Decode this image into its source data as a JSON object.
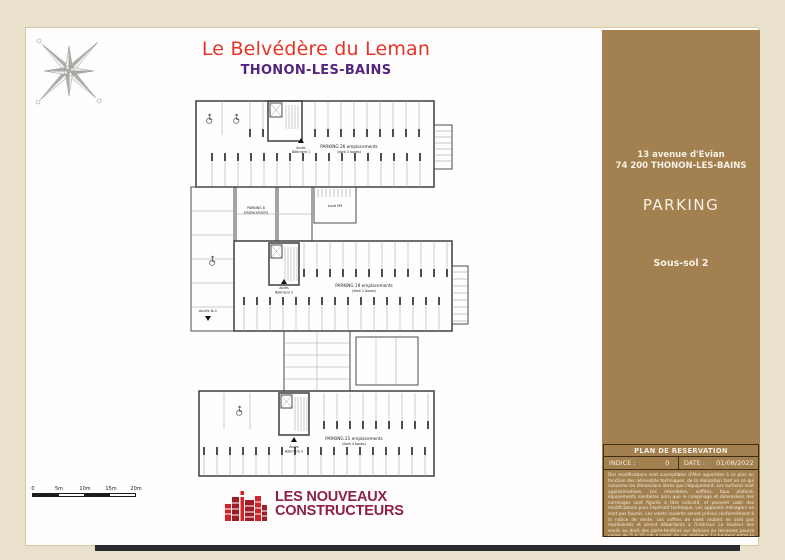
{
  "header": {
    "title": "Le Belvédère du Leman",
    "subtitle": "THONON-LES-BAINS"
  },
  "side_panel": {
    "address_line1": "13 avenue d'Evian",
    "address_line2": "74 200 THONON-LES-BAINS",
    "plan_type": "PARKING",
    "level": "Sous-sol 2"
  },
  "reservation_box": {
    "header": "PLAN DE RESERVATION",
    "indice_label": "INDICE :",
    "indice_value": "0",
    "date_label": "DATE :",
    "date_value": "01/08/2022",
    "disclaimer": "Des modifications sont susceptibles d'être apportées à ce plan en fonction des nécessités techniques, de la réalisation tant en ce qui concerne les dimensions libres que l'équipement. Les surfaces sont approximatives. Les retombées, soffites, faux plafond, équipements sanitaires ainsi que le calepinage et dimensions des carrelages sont figurés à titre indicatif, et peuvent subir des modifications pour impératif technique. Les appareils ménagers ne sont pas fournis. Les volets roulants seront prévus conformément à la notice de vente. Les coffres de volet roulant ne sont pas représentés et seront débordants à l'intérieur. La hauteur des seuils au droit des porte-fenêtres sur balcons ou terrasses pourra varier de 5 à 35 cm à partir du sol intérieur. La hauteur entre le jardin et la terrasse pourra varier entre 0 et 60 cm. Les jardins ne seront pas nécessairement plats et pourront comporter des talus et des pentes."
  },
  "plan": {
    "parking26_line1": "PARKING 26 emplacements",
    "parking26_line2": "(dont 2 boxes)",
    "parking8_line1": "PARKING 8",
    "parking8_line2": "emplacements",
    "parking19_line1": "PARKING 19 emplacements",
    "parking19_line2": "(dont 2 boxes)",
    "parking21_line1": "PARKING 21 emplacements",
    "parking21_line2": "(dont 4 boxes)",
    "acces_b1_line1": "Accès",
    "acces_b1_line2": "Bâtiment 1",
    "acces_b2_line1": "Accès",
    "acces_b2_line2": "Bâtiment 2",
    "acces_b3_line1": "Accès",
    "acces_b3_line2": "Bâtiment 3",
    "acces_n1": "Accès N-1",
    "local_em": "Local EM"
  },
  "scale_bar": {
    "labels": [
      "0",
      "5m",
      "10m",
      "15m",
      "20m"
    ]
  },
  "logo": {
    "line1": "LES NOUVEAUX",
    "line2": "CONSTRUCTEURS"
  },
  "colors": {
    "title_red": "#e6332a",
    "subtitle_purple": "#53267d",
    "panel_brown": "#a3804f",
    "logo_maroon": "#8d2045",
    "logo_red": "#d2232a",
    "page_beige": "#e9e1cb"
  }
}
